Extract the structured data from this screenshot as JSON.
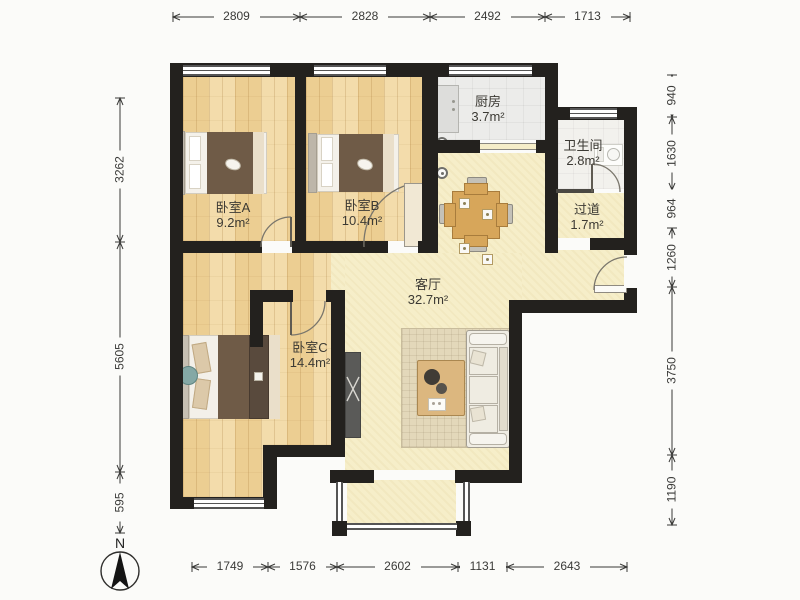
{
  "plan": {
    "title": "apartment-floor-plan",
    "rooms": [
      {
        "id": "bedroom-a",
        "name": "卧室A",
        "area": "9.2m²"
      },
      {
        "id": "bedroom-b",
        "name": "卧室B",
        "area": "10.4m²"
      },
      {
        "id": "kitchen",
        "name": "厨房",
        "area": "3.7m²"
      },
      {
        "id": "bathroom",
        "name": "卫生间",
        "area": "2.8m²"
      },
      {
        "id": "hallway",
        "name": "过道",
        "area": "1.7m²"
      },
      {
        "id": "living-room",
        "name": "客厅",
        "area": "32.7m²"
      },
      {
        "id": "bedroom-c",
        "name": "卧室C",
        "area": "14.4m²"
      }
    ],
    "dimensions": {
      "top": [
        "2809",
        "2828",
        "2492",
        "1713"
      ],
      "bottom": [
        "1749",
        "1576",
        "2602",
        "1131",
        "2643"
      ],
      "left": [
        "3262",
        "5605",
        "595"
      ],
      "right": [
        "940",
        "1630",
        "964",
        "1260",
        "3750",
        "1190"
      ]
    },
    "compass": {
      "label": "N"
    },
    "colors": {
      "page": "#fbfbf9",
      "wall": "#23211e",
      "wood": "#ecce92",
      "pale": "#f6eec9",
      "kitchen_floor": "#ececea",
      "bath_floor": "#f2f1ed",
      "blanket": "#6f5b47",
      "table_wood": "#d7a65a",
      "rug": "#e3d8ba",
      "sofa": "#f0ede4",
      "dim_text": "#3a3a38",
      "label_text": "#3c3a34"
    }
  }
}
